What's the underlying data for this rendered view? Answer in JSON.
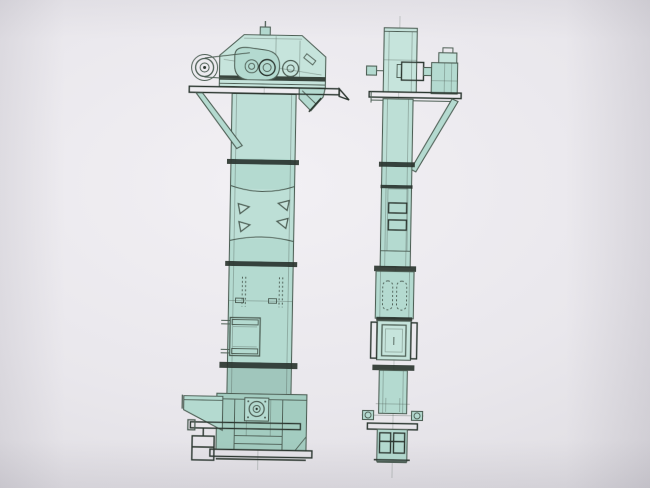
{
  "document": {
    "kind": "scanned technical drawing, no text labels visible",
    "subject": "bucket elevator general arrangement, two orthographic views",
    "views": [
      {
        "id": "front-elevation",
        "parts": [
          "head-housing",
          "vent-cap",
          "motor-pulley",
          "drive-belt",
          "drive-pulley",
          "belt-guard",
          "discharge-spout",
          "head-platform",
          "support-brace",
          "elevator-casing",
          "casing-flange-joints",
          "panel-clips",
          "bolt-strips",
          "inspection-door",
          "inlet-hopper",
          "boot-section",
          "take-up-bearing",
          "take-up-beam",
          "counterweight"
        ]
      },
      {
        "id": "side-elevation",
        "parts": [
          "head-casing",
          "shaft-stub",
          "drive-motor",
          "coupling",
          "gear-reducer",
          "head-platform",
          "support-brace",
          "elevator-casing",
          "casing-flange-joints",
          "hatch-plates",
          "bolt-ovals",
          "inspection-door",
          "side-flange-plates",
          "boot-section",
          "take-up-shaft",
          "boot-flange-plate",
          "counterweights"
        ]
      }
    ]
  },
  "colors": {
    "paper_light": "#f2f0f4",
    "paper_mid": "#e9e7ec",
    "paper_dark": "#d5d3d9",
    "fill_base": "#b4dad0",
    "fill_light": "#c6e4dc",
    "fill_dark": "#a3ccc0",
    "fill_shadow": "#90b7ab",
    "line": "#4d5e54",
    "line_heavy": "#2b362f",
    "hatch_bg": "#8fb3a6",
    "hatch_line": "#20291f"
  }
}
